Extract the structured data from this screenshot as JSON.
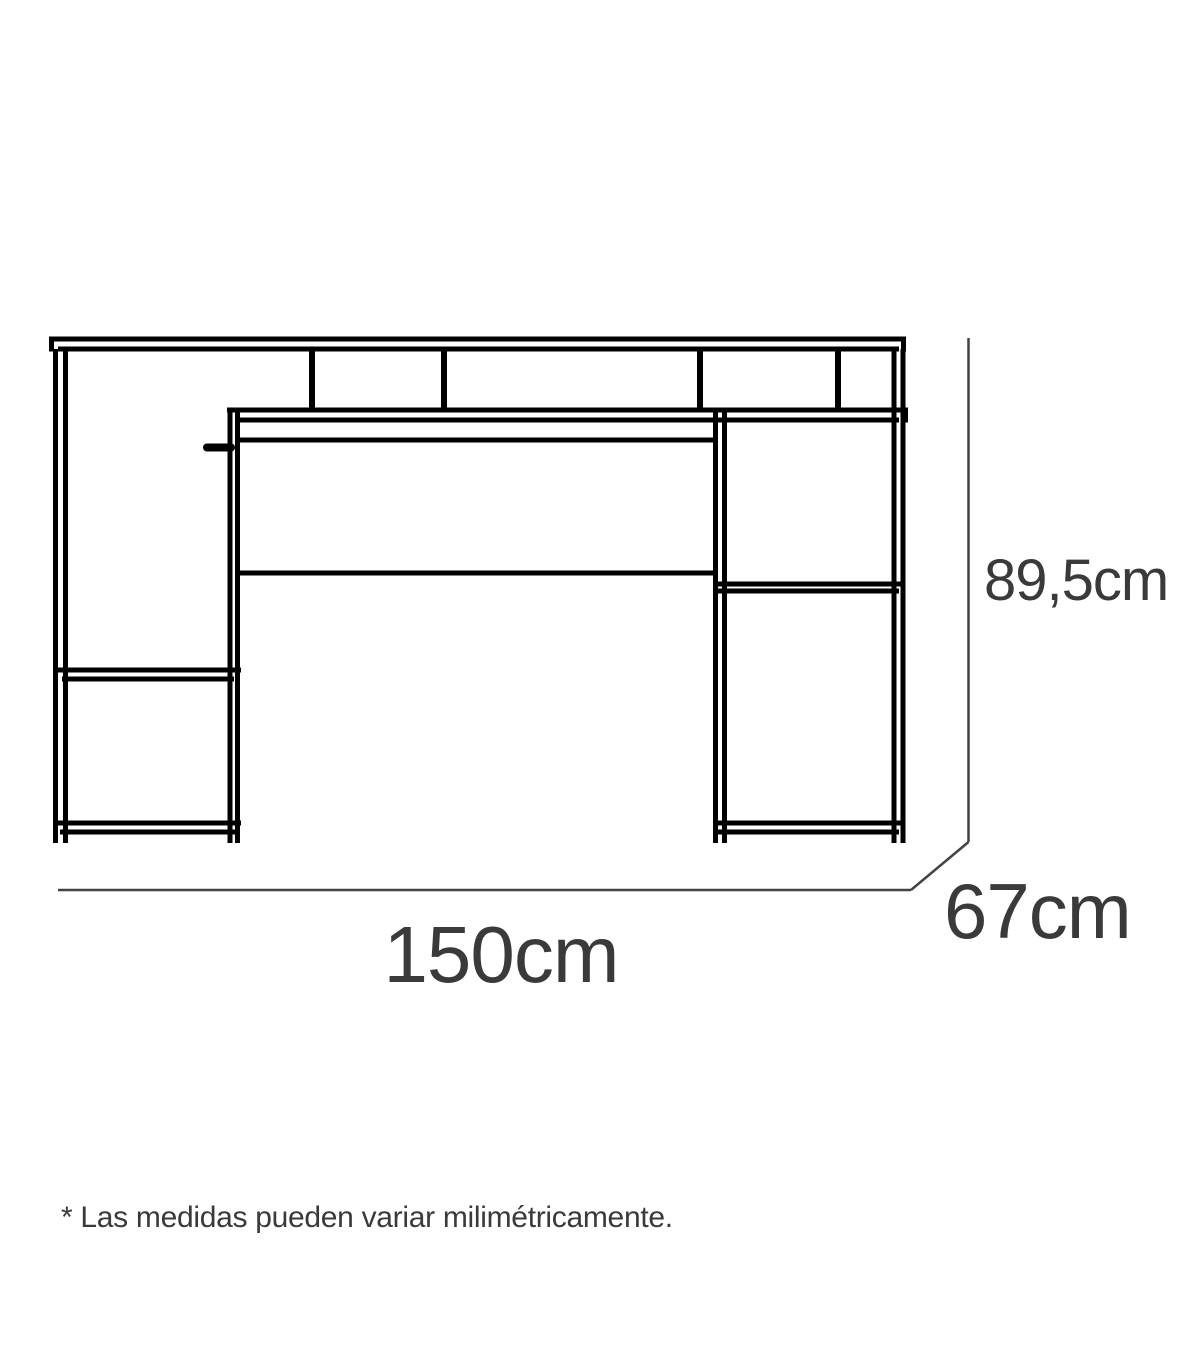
{
  "figure": {
    "kind": "furniture-dimension-diagram",
    "subject": "desk-with-top-riser-shelf",
    "dimensions": {
      "width_label": "150cm",
      "height_label": "89,5cm",
      "depth_label": "67cm"
    },
    "footnote": "* Las medidas pueden variar milimétricamente.",
    "colors": {
      "background": "#ffffff",
      "drawing_line": "#000000",
      "dimension_line": "#434343",
      "label_text": "#3a3a3a"
    }
  }
}
